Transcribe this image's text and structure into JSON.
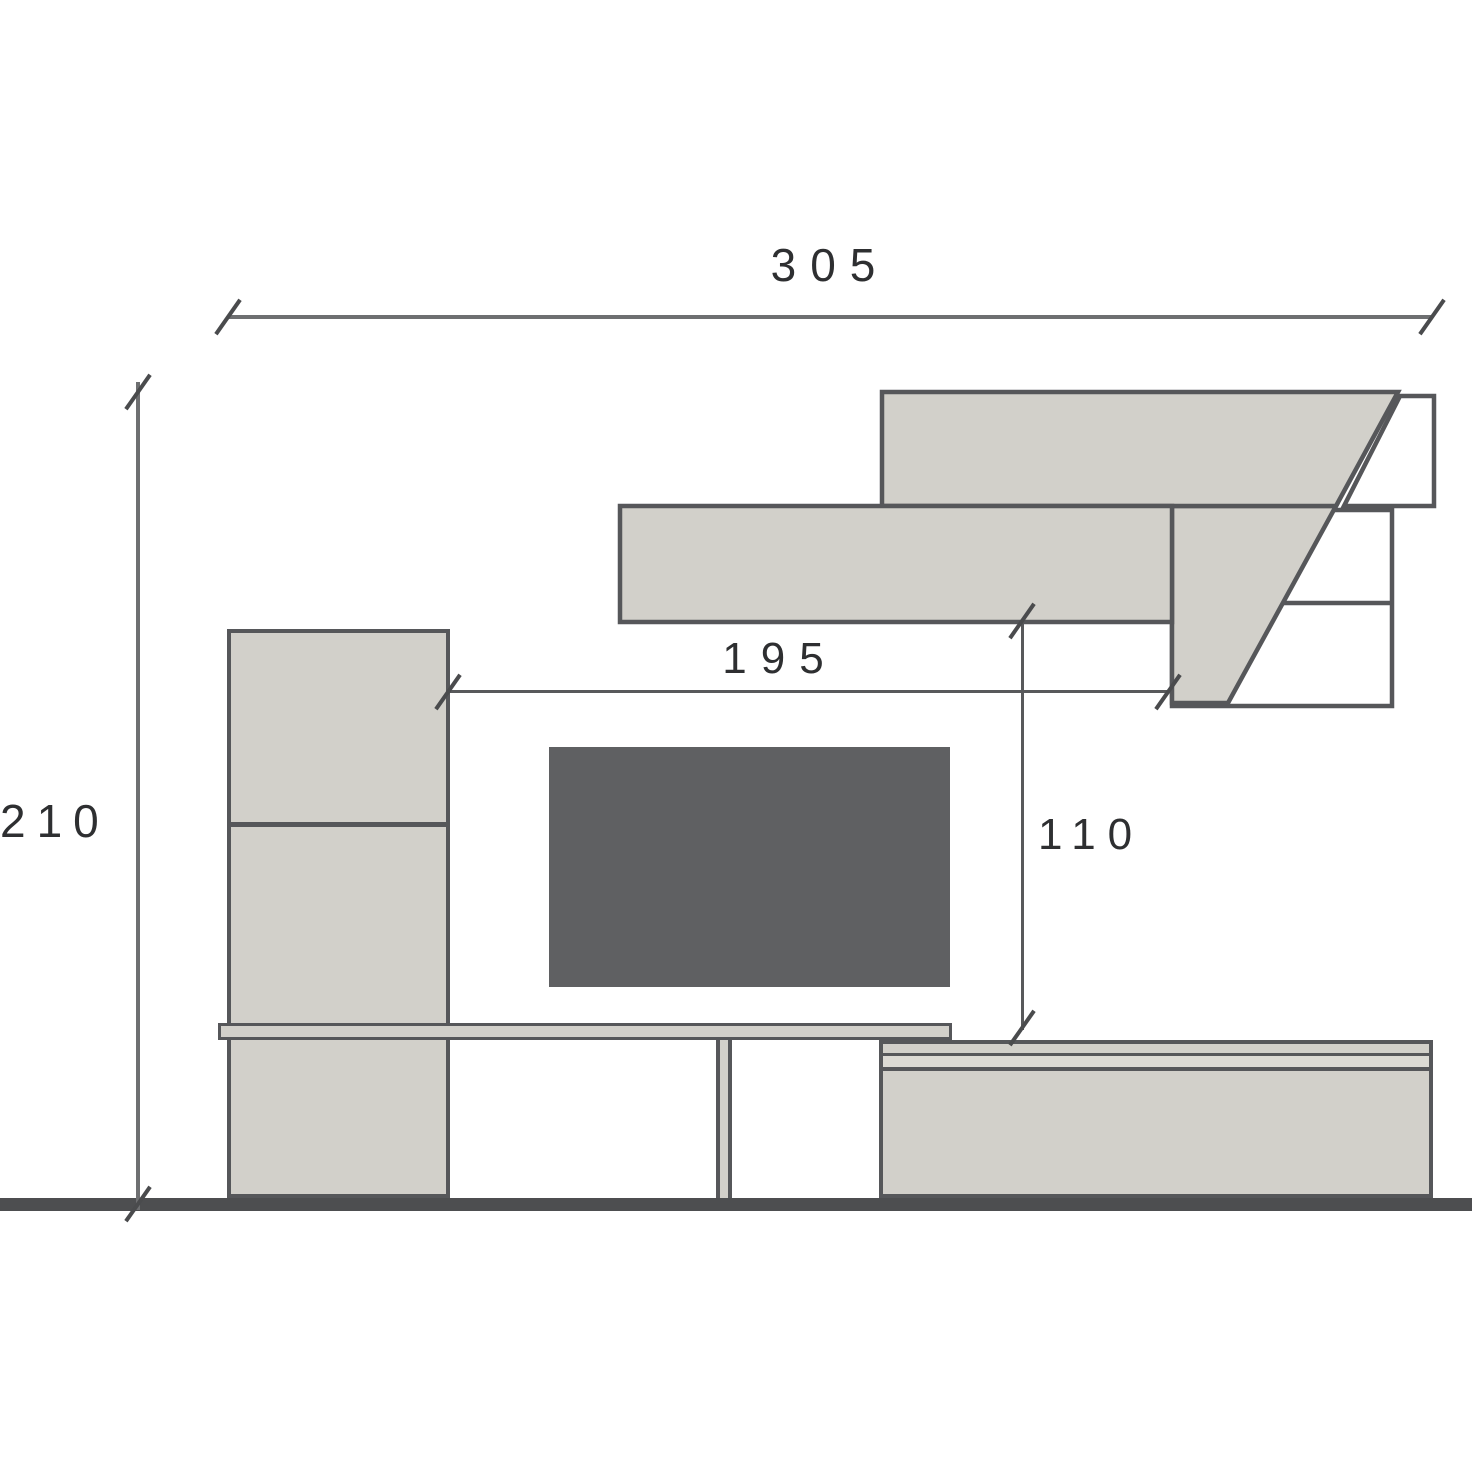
{
  "title": "Wall unit elevation drawing",
  "dimensions": {
    "total_width": "305",
    "total_height": "210",
    "niche_width": "195",
    "niche_height": "110"
  },
  "colors": {
    "background": "#ffffff",
    "panel_fill": "#d2d0ca",
    "panel_fill_light": "#dcdad4",
    "outline": "#56575a",
    "dimension_line": "#6e6f71",
    "tick": "#4a4b4d",
    "text": "#2e2f31",
    "tv_fill": "#5f6062",
    "floor": "#4d4e50"
  }
}
